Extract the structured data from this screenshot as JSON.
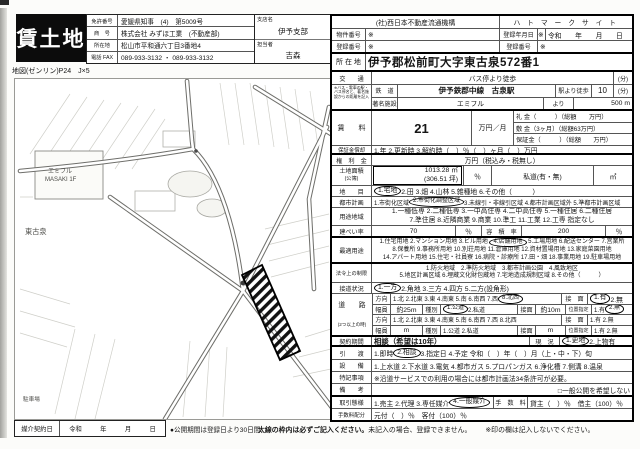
{
  "doc": {
    "title": "賃土地",
    "map_ref": "地図(ゼンリン)P24　J×5",
    "agency": {
      "r1l": "免許番号",
      "r1v": "愛媛県知事　(4)　第5009号",
      "r2l": "商　号",
      "r2v": "株式会社 みずほ工業　(不動産部)",
      "r3l": "所在地",
      "r3v": "松山市平和通六丁目3番地4",
      "r4l": "電話 FAX",
      "r4v": "089-933-3132 ・ 089-933-3132"
    },
    "branch": {
      "l1": "支店名",
      "v1": "伊予支部",
      "l2": "担当者",
      "v2": "吉森"
    }
  },
  "map": {
    "district": "東古泉",
    "mall1": "エミフル",
    "mall2": "MASAKI 1F",
    "parking": "駐車場"
  },
  "right": {
    "org": {
      "left": "(社)西日本不動産流通機構",
      "right": "ハ ト マ ー ク サ イ ト"
    },
    "row2": {
      "l1": "物件番号",
      "a1": "※",
      "l2": "登録年月日",
      "a2": "※",
      "v2": "令和　　年　　月　　日"
    },
    "row3": {
      "l1": "登録番号",
      "a1": "※",
      "l2": "登録番号",
      "a2": "※"
    },
    "loc": {
      "label": "所 在 地",
      "value": "伊予郡松前町大字東古泉572番1"
    },
    "kotsu": {
      "label": "交　　通",
      "value": "バス停より徒歩",
      "unit": "(分)"
    },
    "note": "※バス・電車の駅・バス停名と、著名施設からの距離を記入",
    "rail": {
      "label": "鉄　道",
      "value": "伊予鉄郡中線　古泉駅",
      "walk": "駅より徒歩",
      "min": "10",
      "unit": "(分)"
    },
    "fac": {
      "label": "著名施設",
      "value": "エミフル",
      "yori": "より",
      "dist": "500 m"
    },
    "rent": {
      "label": "賃　　料",
      "value": "21",
      "unit": "万円／月",
      "reikin": "礼 金（　　　）（総額　　万円）",
      "shikikin": "敷 金（3ヶ月）（総額63万円）",
      "hoshokin": "保証金（　　　）（総額　　万円）"
    },
    "sho": {
      "label": "保証金償却",
      "value": "1.年 2.更新時 3.解約時（　）％（　）ヶ月（　）万円"
    },
    "kenri": {
      "label": "権　利　金",
      "value": "万円（税込み・税無し）"
    },
    "area": {
      "label": "土地面積",
      "sub": "(公簿)",
      "m2": "1013.28 ㎡",
      "tsubo": "(306.51 坪)",
      "pct": "％",
      "shido": "私道(有・無)",
      "m2b": "㎡"
    },
    "chimoku": {
      "label": "地　　目",
      "sel": "1.宅地",
      "post": " 2.田 3.畑 4.山林 5.雑種地 6.その他（　　　）"
    },
    "toshi": {
      "label": "都市計画",
      "pre": "1.市街化区域 ",
      "sel": "2.市街化調整区域",
      "post": " 3.未線引・非線引区域 4.都市計画区域外 5.準都市計画区域"
    },
    "yoto": {
      "label": "用途地域",
      "l1": "1.一種低専 2.二種低専 3.一中高住専 4.二中高住専 5.一種住居 6.二種住居",
      "l2": "7.準住居 8.近隣商業 9.商業 10.準工 11.工業 12.工専 指定なし"
    },
    "kenpei": {
      "label": "建ぺい率",
      "value": "70",
      "pct": "％",
      "label2": "容　積　率",
      "value2": "200",
      "pct2": "％"
    },
    "saiteki": {
      "label": "最適用途",
      "l1pre": "1.住宅用地 2.マンション用地 3.ビル用地 ",
      "l1sel": "4.店舗用地",
      "l1post": " 5.工場用地 6.配送センター 7.営業所",
      "l2": "8.保養所 9.事務所用地 10.別荘用地 11.倉庫用地 12.資材置場用地 13.家庭菜園用地",
      "l3": "14.アパート用地 15.住宅・社員寮 16.病院・診療所 17.田・畑 18.事業用地 19.駐車場用地"
    },
    "horei": {
      "label": "法令上の制限",
      "l1": "1.防火地域　2.準防火地域　3.都市計画公園　4.風致地区",
      "l2": "5.地区計画区域 6.埋蔵文化財包蔵地 7.宅地造成規制区域 8.その他（　　　）"
    },
    "setsudo": {
      "label": "接道状況",
      "sel": "1.一方",
      "post": " 2.角地 3.三方 4.四方 5.二方(設角形)"
    },
    "road": {
      "label": "道　　路",
      "label2": "(2つ以上の時)",
      "r1": {
        "l": "方向",
        "pre": "1.北 2.北東 3.東 4.南東 5.南 6.南西 7.西 ",
        "sel": "8.北西",
        "rl": "接　面",
        "rsel": "1.有",
        "rpost": " 2.無"
      },
      "r2": {
        "l": "幅員",
        "v": "約25m",
        "l2": "種別",
        "sel": "1.公道",
        "post": " 2.私道",
        "l3": "接面",
        "v3": "約10m",
        "l4": "位置指定",
        "pre4": "1.有 ",
        "sel4": "2.無"
      },
      "r3": {
        "l": "方向",
        "v": "1.北 2.北東 3.東 4.南東 5.南 6.南西 7.西 8.北西",
        "rl": "接　面",
        "rv": "1.有 2.無"
      },
      "r4": {
        "l": "幅員",
        "v": "m",
        "l2": "種別",
        "v2": "1.公道 2.私道",
        "l3": "接面",
        "v3": "m",
        "l4": "位置指定",
        "v4": "1.有 2.無"
      }
    },
    "keiyaku": {
      "label": "契約期間",
      "value": "相談（希望は10年）",
      "gl": "現　況",
      "sel": "1.更地",
      "post": " 2.上物有"
    },
    "hiki": {
      "label": "引　　渡",
      "pre": "1.即時 ",
      "sel": "2.相談",
      "post": " 3.指定日 4.予定 令和（　）年（　）月（上・中・下）旬"
    },
    "setsubi": {
      "label": "設　　備",
      "value": "1.上水道 2.下水道 3.電気 4.都市ガス 5.プロパンガス 6.浄化槽 7.側溝 8.温泉"
    },
    "tokki": {
      "label": "特記事項",
      "value": "※沿道サービスでの利用の場合には都市計画法34条許可が必要。"
    },
    "biko": {
      "label": "備　　考",
      "value": "□一般公開を希望しない"
    },
    "tori": {
      "label": "取引態様",
      "pre": "1.売主 2.代理 3.専任媒介 ",
      "sel": "4.一般媒介",
      "tl": "手　数　料",
      "value": "貸主（　）％　借主（100）％"
    },
    "haibun": {
      "label": "手数料配分",
      "value": "元付（　）％　客付（100）％"
    }
  },
  "bottom": {
    "mdate_label": "媒介契約日",
    "era": "令和",
    "y": "年",
    "m": "月",
    "d": "日",
    "open": "●公開期間は登録日より30日間",
    "note_bold": "太線の枠内は必ずご記入ください。",
    "note_rest": "未記入の場合、登録できません。",
    "note_ast": "※印の欄は記入しないでください。"
  },
  "colors": {
    "ink": "#151515",
    "paper": "#fcfcfa",
    "title_bg": "#0c0c0c"
  }
}
